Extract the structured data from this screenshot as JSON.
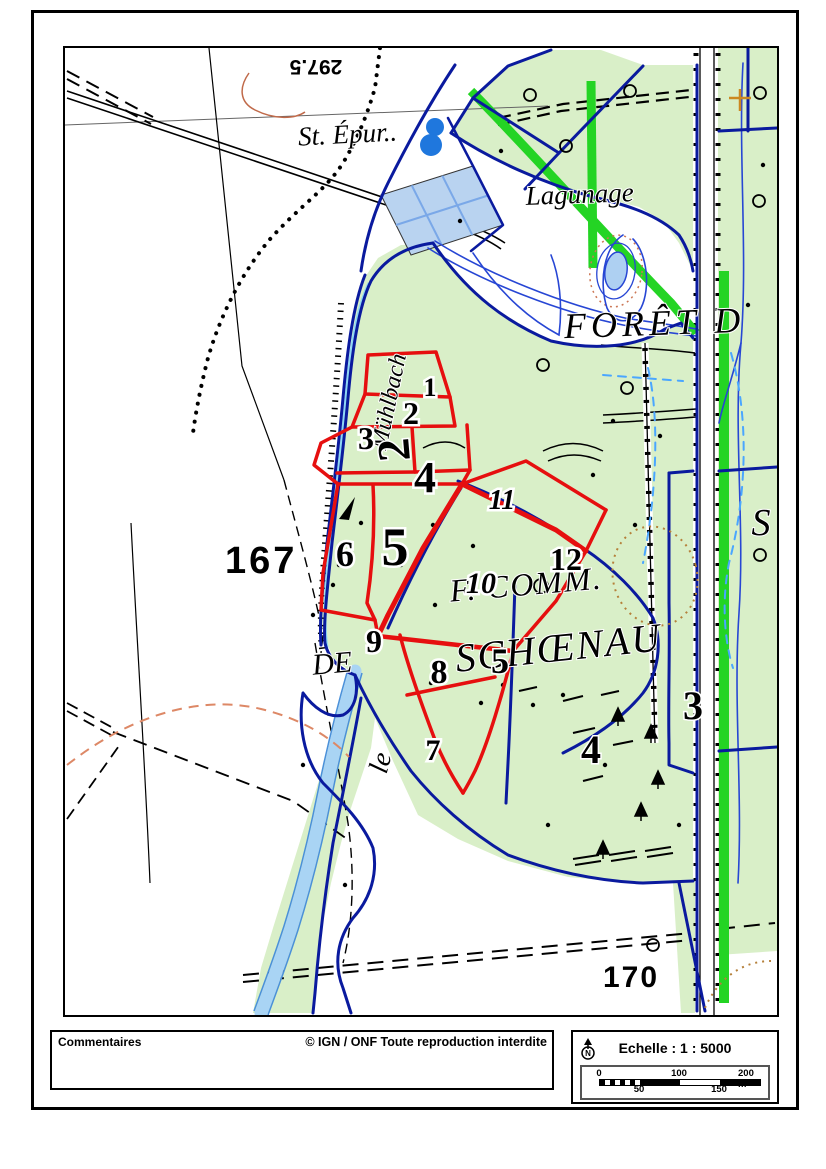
{
  "footer": {
    "comments_label": "Commentaires",
    "copyright": "© IGN / ONF Toute reproduction interdite",
    "scale_title": "Echelle : 1 : 5000",
    "north_label": "N",
    "scale_bar": {
      "tick_0": "0",
      "tick_50": "50",
      "tick_100": "100",
      "tick_150": "150",
      "tick_200": "200 m"
    }
  },
  "map": {
    "place_labels": {
      "st_epur": "St. Épur..",
      "lagunage": "Lagunage",
      "foret": "FORÊT D",
      "f_comm": "F. COMM.",
      "de": "DE",
      "schoenau": "SCHŒNAU",
      "le": "le",
      "muhlbach": "Mühlbach",
      "s_cut": "S"
    },
    "spot_heights": {
      "h167": "167",
      "h170": "170",
      "contour_297": "297.5"
    },
    "parcels": [
      {
        "label": "1"
      },
      {
        "label": "2"
      },
      {
        "label": "3"
      },
      {
        "label": "4"
      },
      {
        "label": "5"
      },
      {
        "label": "6"
      },
      {
        "label": "7"
      },
      {
        "label": "8"
      },
      {
        "label": "9"
      },
      {
        "label": "10"
      },
      {
        "label": "11"
      },
      {
        "label": "12"
      }
    ],
    "compartments": [
      {
        "label": "2"
      },
      {
        "label": "5"
      },
      {
        "label": "4"
      },
      {
        "label": "3"
      }
    ],
    "colors": {
      "forest_green": "#d9efc8",
      "bright_green": "#24d424",
      "boundary_navy": "#0a1a9e",
      "stream_blue": "#2746d4",
      "water_light": "#b9d3f0",
      "pond_blue": "#1f77dd",
      "parcel_red": "#e60f0f",
      "contour_orange": "#c06a4a",
      "contour_salmon": "#dd8866",
      "contour_tan": "#b5803a"
    }
  }
}
